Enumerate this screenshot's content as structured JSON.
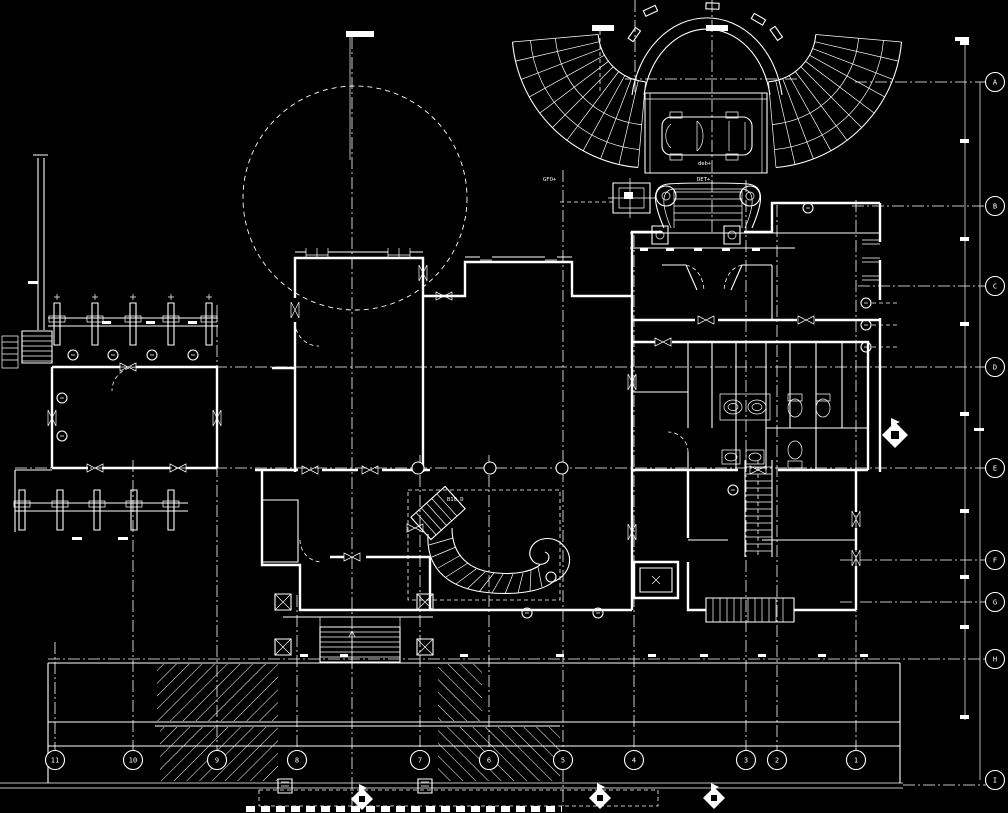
{
  "canvas": {
    "width": 1008,
    "height": 813,
    "background": "#000000",
    "line_color": "#ffffff"
  },
  "drawing": {
    "kind": "architectural floor plan, CAD dark background"
  },
  "grid": {
    "bubble_radius": 9.5,
    "bottom_columns": {
      "y": 760,
      "items": [
        {
          "label": "11",
          "x": 55
        },
        {
          "label": "10",
          "x": 133
        },
        {
          "label": "9",
          "x": 217
        },
        {
          "label": "8",
          "x": 297
        },
        {
          "label": "7",
          "x": 420
        },
        {
          "label": "6",
          "x": 489
        },
        {
          "label": "5",
          "x": 563
        },
        {
          "label": "4",
          "x": 634
        },
        {
          "label": "3",
          "x": 746
        },
        {
          "label": "2",
          "x": 777
        },
        {
          "label": "1",
          "x": 856
        }
      ]
    },
    "right_rows": {
      "x": 995,
      "items": [
        {
          "label": "A",
          "y": 82
        },
        {
          "label": "B",
          "y": 206
        },
        {
          "label": "C",
          "y": 286
        },
        {
          "label": "D",
          "y": 367
        },
        {
          "label": "E",
          "y": 468
        },
        {
          "label": "F",
          "y": 560
        },
        {
          "label": "G",
          "y": 602
        },
        {
          "label": "H",
          "y": 659
        },
        {
          "label": "I",
          "y": 780
        }
      ]
    },
    "intersection_markers": [
      {
        "x": 418,
        "y": 468
      },
      {
        "x": 490,
        "y": 468
      },
      {
        "x": 562,
        "y": 468
      }
    ]
  },
  "spot_labels": [
    {
      "text": "GFO+",
      "x": 543,
      "y": 181
    },
    {
      "text": "deb+",
      "x": 698,
      "y": 165
    },
    {
      "text": "DET+",
      "x": 697,
      "y": 181
    },
    {
      "text": "B10 D",
      "x": 447,
      "y": 501
    }
  ]
}
